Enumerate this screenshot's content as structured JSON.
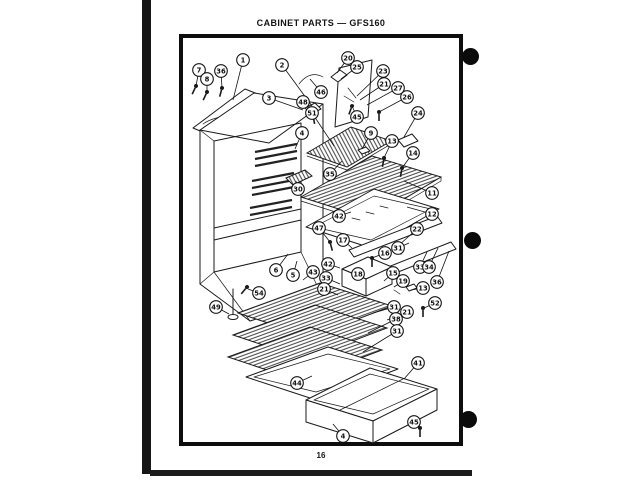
{
  "page": {
    "title": "CABINET PARTS — GFS160",
    "page_number": "16"
  },
  "colors": {
    "ink": "#111111",
    "paper": "#ffffff"
  },
  "diagram": {
    "callouts": [
      {
        "n": "7",
        "x": 199,
        "y": 70,
        "t": [
          196,
          86
        ]
      },
      {
        "n": "8",
        "x": 207,
        "y": 79,
        "t": [
          207,
          92
        ]
      },
      {
        "n": "36",
        "x": 221,
        "y": 71,
        "t": [
          222,
          88
        ]
      },
      {
        "n": "1",
        "x": 243,
        "y": 60,
        "t": [
          233,
          100
        ]
      },
      {
        "n": "2",
        "x": 282,
        "y": 65,
        "t": [
          312,
          106
        ]
      },
      {
        "n": "3",
        "x": 269,
        "y": 98,
        "t": [
          303,
          110
        ]
      },
      {
        "n": "48",
        "x": 303,
        "y": 102,
        "t": [
          312,
          112
        ]
      },
      {
        "n": "46",
        "x": 321,
        "y": 92,
        "t": [
          310,
          79
        ]
      },
      {
        "n": "51",
        "x": 312,
        "y": 113,
        "t": [
          334,
          146
        ]
      },
      {
        "n": "4",
        "x": 302,
        "y": 133,
        "t": [
          295,
          149
        ]
      },
      {
        "n": "20",
        "x": 348,
        "y": 58,
        "t": [
          337,
          73
        ]
      },
      {
        "n": "25",
        "x": 357,
        "y": 67,
        "t": [
          341,
          79
        ]
      },
      {
        "n": "23",
        "x": 383,
        "y": 71,
        "t": [
          357,
          96
        ]
      },
      {
        "n": "21",
        "x": 384,
        "y": 84,
        "t": [
          360,
          100
        ]
      },
      {
        "n": "27",
        "x": 398,
        "y": 88,
        "t": [
          367,
          105
        ]
      },
      {
        "n": "26",
        "x": 407,
        "y": 97,
        "t": [
          379,
          112
        ]
      },
      {
        "n": "24",
        "x": 418,
        "y": 113,
        "t": [
          404,
          137
        ]
      },
      {
        "n": "45",
        "x": 357,
        "y": 117,
        "t": [
          352,
          106
        ]
      },
      {
        "n": "9",
        "x": 371,
        "y": 133,
        "t": [
          362,
          149
        ]
      },
      {
        "n": "13",
        "x": 392,
        "y": 141,
        "t": [
          384,
          158
        ]
      },
      {
        "n": "14",
        "x": 413,
        "y": 153,
        "t": [
          402,
          168
        ]
      },
      {
        "n": "35",
        "x": 330,
        "y": 174,
        "t": [
          342,
          161
        ]
      },
      {
        "n": "30",
        "x": 298,
        "y": 189,
        "t": [
          296,
          181
        ]
      },
      {
        "n": "11",
        "x": 432,
        "y": 193,
        "t": [
          404,
          181
        ]
      },
      {
        "n": "12",
        "x": 432,
        "y": 214,
        "t": [
          407,
          207
        ]
      },
      {
        "n": "42",
        "x": 339,
        "y": 216,
        "t": [
          351,
          212
        ]
      },
      {
        "n": "47",
        "x": 319,
        "y": 228,
        "t": [
          330,
          242
        ]
      },
      {
        "n": "17",
        "x": 343,
        "y": 240,
        "t": [
          352,
          248
        ]
      },
      {
        "n": "22",
        "x": 417,
        "y": 229,
        "t": [
          398,
          246
        ]
      },
      {
        "n": "16",
        "x": 385,
        "y": 253,
        "t": [
          372,
          258
        ]
      },
      {
        "n": "31",
        "x": 398,
        "y": 248,
        "t": [
          409,
          243
        ]
      },
      {
        "n": "33",
        "x": 420,
        "y": 267,
        "t": [
          427,
          252
        ]
      },
      {
        "n": "34",
        "x": 429,
        "y": 267,
        "t": [
          438,
          248
        ]
      },
      {
        "n": "18",
        "x": 358,
        "y": 274,
        "t": [
          355,
          270
        ]
      },
      {
        "n": "15",
        "x": 393,
        "y": 273,
        "t": [
          384,
          281
        ]
      },
      {
        "n": "19",
        "x": 403,
        "y": 281,
        "t": [
          394,
          287
        ]
      },
      {
        "n": "13",
        "x": 423,
        "y": 288,
        "t": [
          411,
          290
        ]
      },
      {
        "n": "36",
        "x": 437,
        "y": 282,
        "t": [
          449,
          251
        ]
      },
      {
        "n": "52",
        "x": 435,
        "y": 303,
        "t": [
          424,
          308
        ]
      },
      {
        "n": "42",
        "x": 328,
        "y": 264,
        "t": [
          340,
          268
        ]
      },
      {
        "n": "43",
        "x": 313,
        "y": 272,
        "t": [
          303,
          280
        ]
      },
      {
        "n": "33",
        "x": 326,
        "y": 278,
        "t": [
          340,
          284
        ]
      },
      {
        "n": "21",
        "x": 324,
        "y": 289,
        "t": [
          338,
          295
        ]
      },
      {
        "n": "6",
        "x": 276,
        "y": 270,
        "t": [
          288,
          254
        ]
      },
      {
        "n": "5",
        "x": 293,
        "y": 275,
        "t": [
          297,
          261
        ]
      },
      {
        "n": "54",
        "x": 259,
        "y": 293,
        "t": [
          248,
          289
        ]
      },
      {
        "n": "49",
        "x": 216,
        "y": 307,
        "t": [
          229,
          314
        ]
      },
      {
        "n": "31",
        "x": 394,
        "y": 307,
        "t": [
          373,
          313
        ]
      },
      {
        "n": "21",
        "x": 407,
        "y": 312,
        "t": [
          387,
          320
        ]
      },
      {
        "n": "38",
        "x": 396,
        "y": 319,
        "t": [
          368,
          333
        ]
      },
      {
        "n": "31",
        "x": 397,
        "y": 331,
        "t": [
          363,
          352
        ]
      },
      {
        "n": "41",
        "x": 418,
        "y": 363,
        "t": [
          404,
          379
        ]
      },
      {
        "n": "44",
        "x": 297,
        "y": 383,
        "t": [
          312,
          376
        ]
      },
      {
        "n": "4",
        "x": 343,
        "y": 436,
        "t": [
          333,
          424
        ]
      },
      {
        "n": "45",
        "x": 414,
        "y": 422,
        "t": [
          420,
          429
        ]
      }
    ]
  }
}
